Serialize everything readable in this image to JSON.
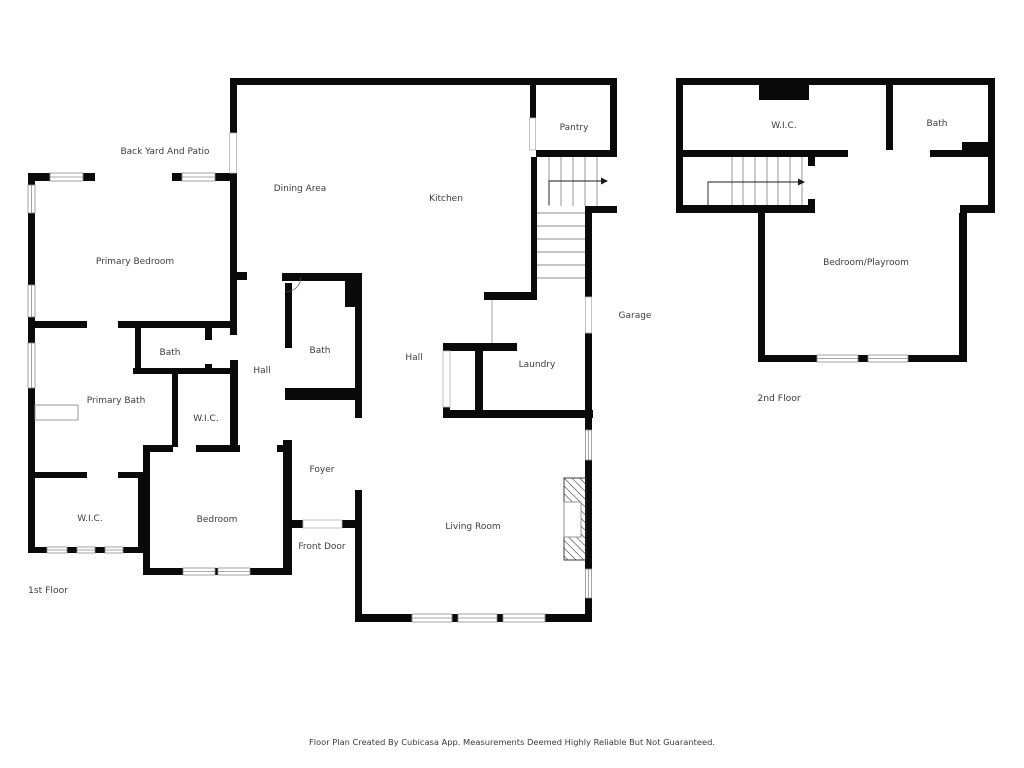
{
  "colors": {
    "wall": "#0a0a0a",
    "label": "#3d3d3d",
    "window_frame": "#8c8c8c",
    "stair_tread": "#8c8c8c",
    "arrow": "#1a1a1a",
    "background": "#ffffff"
  },
  "footer": {
    "text": "Floor Plan Created By Cubicasa App. Measurements Deemed Highly Reliable But Not Guaranteed."
  },
  "first_floor": {
    "floor_label": "1st Floor",
    "outdoor_label": "Back Yard And Patio",
    "rooms": {
      "dining_area": "Dining Area",
      "kitchen": "Kitchen",
      "pantry": "Pantry",
      "primary_bedroom": "Primary Bedroom",
      "bath_left": "Bath",
      "hall_left": "Hall",
      "primary_bath": "Primary Bath",
      "wic_mid": "W.I.C.",
      "bath_mid": "Bath",
      "hall_mid": "Hall",
      "laundry": "Laundry",
      "garage": "Garage",
      "wic_front": "W.I.C.",
      "bedroom": "Bedroom",
      "foyer": "Foyer",
      "front_door": "Front Door",
      "living_room": "Living Room"
    }
  },
  "second_floor": {
    "floor_label": "2nd Floor",
    "rooms": {
      "wic": "W.I.C.",
      "bath": "Bath",
      "bedroom_playroom": "Bedroom/Playroom"
    }
  }
}
